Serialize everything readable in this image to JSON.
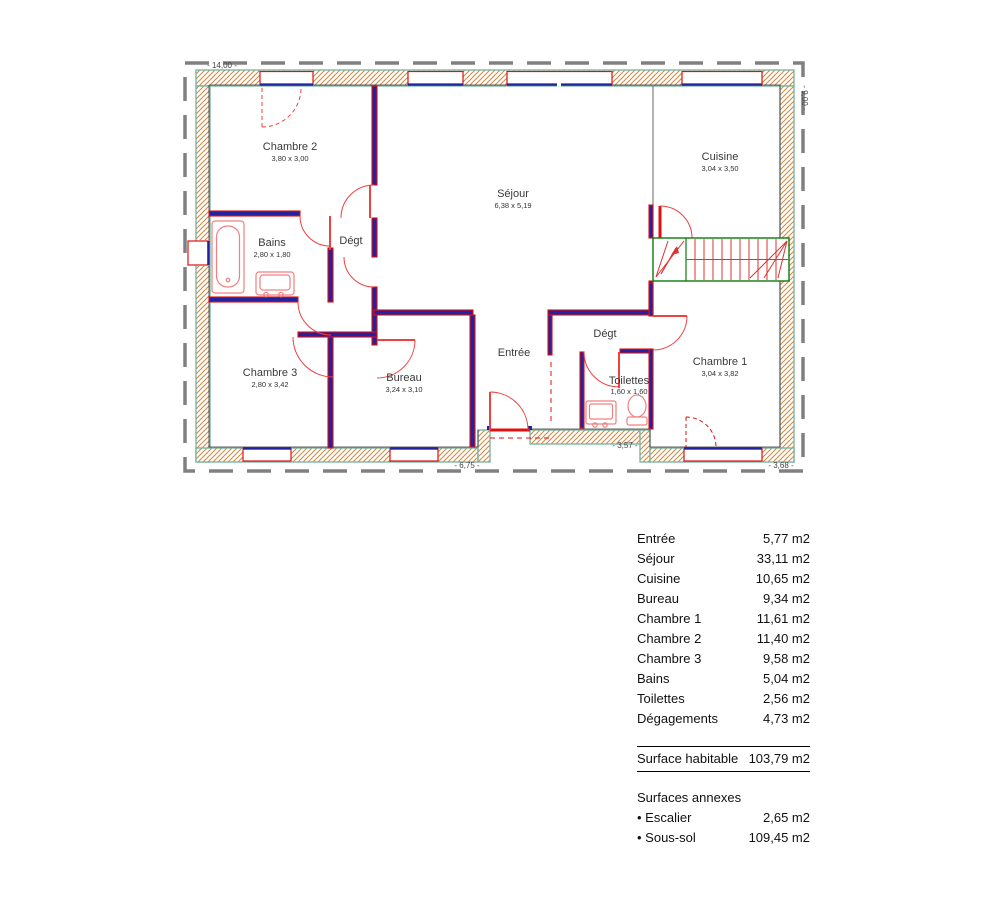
{
  "plan": {
    "labels": {
      "chambre2": {
        "name": "Chambre 2",
        "dims": "3,80 x 3,00"
      },
      "sejour": {
        "name": "Séjour",
        "dims": "6,38 x 5,19"
      },
      "cuisine": {
        "name": "Cuisine",
        "dims": "3,04 x 3,50"
      },
      "bains": {
        "name": "Bains",
        "dims": "2,80 x 1,80"
      },
      "degt1": {
        "name": "Dégt"
      },
      "chambre3": {
        "name": "Chambre 3",
        "dims": "2,80 x 3,42"
      },
      "bureau": {
        "name": "Bureau",
        "dims": "3,24 x 3,10"
      },
      "entree": {
        "name": "Entrée"
      },
      "degt2": {
        "name": "Dégt"
      },
      "toilettes": {
        "name": "Toilettes",
        "dims": "1,60 x 1,60"
      },
      "chambre1": {
        "name": "Chambre 1",
        "dims": "3,04 x 3,82"
      }
    },
    "dims": {
      "top": "- 14,00 -",
      "right": "- 9,00 -",
      "bottom_left": "- 6,75 -",
      "bottom_mid": "- 3,57 -",
      "bottom_right": "- 3,68 -"
    },
    "colors": {
      "wall_core": "#2323a0",
      "wall_edge": "#e01010",
      "hatch": "#d08b45",
      "band_outline": "#76b2a2",
      "stairs": "#0a7a0a",
      "fixtures": "#f08080",
      "boundary": "#808080"
    }
  },
  "areas": {
    "rows": [
      {
        "label": "Entrée",
        "value": "5,77 m2"
      },
      {
        "label": "Séjour",
        "value": "33,11 m2"
      },
      {
        "label": "Cuisine",
        "value": "10,65 m2"
      },
      {
        "label": "Bureau",
        "value": "9,34 m2"
      },
      {
        "label": "Chambre 1",
        "value": "11,61 m2"
      },
      {
        "label": "Chambre 2",
        "value": "11,40 m2"
      },
      {
        "label": "Chambre 3",
        "value": "9,58 m2"
      },
      {
        "label": "Bains",
        "value": "5,04 m2"
      },
      {
        "label": "Toilettes",
        "value": "2,56 m2"
      },
      {
        "label": "Dégagements",
        "value": "4,73 m2"
      }
    ],
    "total": {
      "label": "Surface habitable",
      "value": "103,79 m2"
    },
    "annex": {
      "title": "Surfaces annexes",
      "rows": [
        {
          "label": "• Escalier",
          "value": "2,65 m2"
        },
        {
          "label": "• Sous-sol",
          "value": "109,45 m2"
        }
      ]
    }
  }
}
